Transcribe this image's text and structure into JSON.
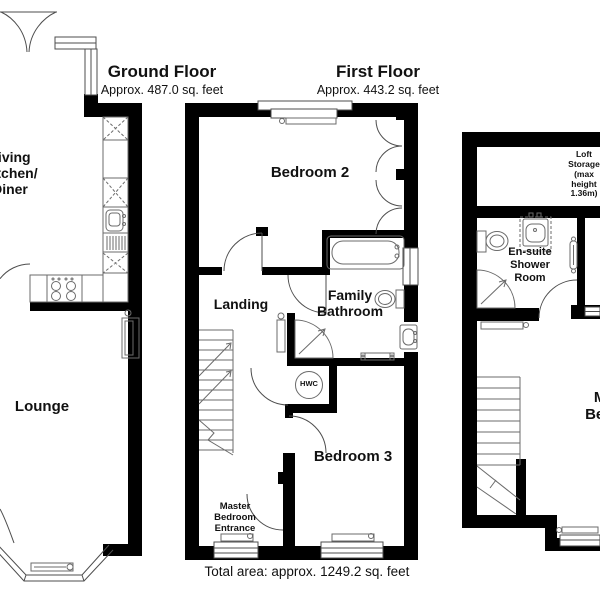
{
  "colors": {
    "wall": "#000000",
    "line": "#4d4d4d",
    "text": "#111111",
    "background": "#ffffff"
  },
  "floors": {
    "ground": {
      "title": "Ground Floor",
      "area": "Approx. 487.0 sq. feet",
      "living": [
        "Living",
        "Kitchen/",
        "Diner"
      ],
      "lounge": "Lounge"
    },
    "first": {
      "title": "First Floor",
      "area": "Approx. 443.2 sq. feet",
      "bedroom2": "Bedroom 2",
      "landing": "Landing",
      "bathroom": [
        "Family",
        "Bathroom"
      ],
      "bedroom3": "Bedroom 3",
      "hwc": "HWC",
      "master_entrance": [
        "Master",
        "Bedroom",
        "Entrance"
      ]
    },
    "second": {
      "loft": [
        "Loft",
        "Storage",
        "(max",
        "height",
        "1.36m)"
      ],
      "ensuite": [
        "En-suite",
        "Shower",
        "Room"
      ],
      "master": [
        "Master",
        "Bedroom"
      ]
    }
  },
  "footer": {
    "total_area": "Total area: approx. 1249.2 sq. feet"
  },
  "fixtures": [
    "bathtub",
    "toilet",
    "sink",
    "corner-shower",
    "stairs",
    "radiator",
    "window",
    "door",
    "kitchen-units",
    "kitchen-sink",
    "cooker",
    "hot-water-cylinder",
    "wardrobe",
    "bay-window",
    "towel-rail"
  ]
}
